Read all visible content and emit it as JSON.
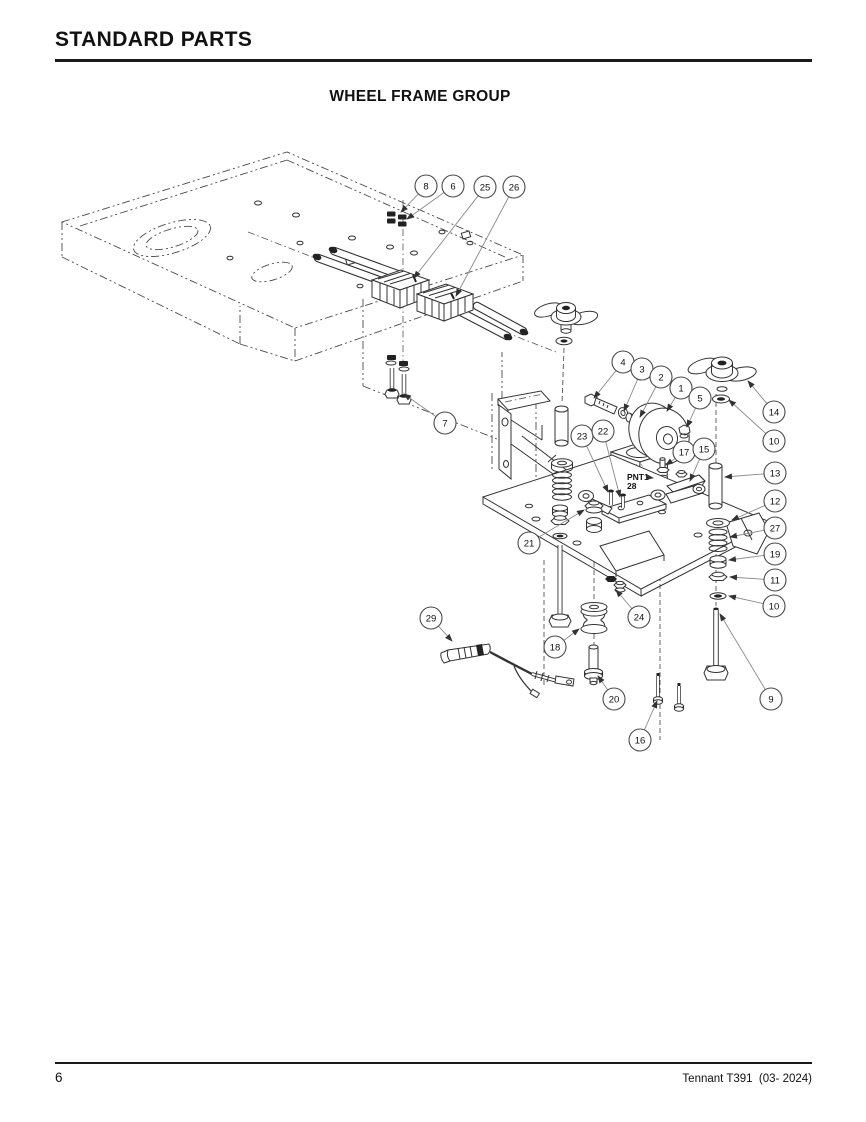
{
  "page": {
    "header_title": "STANDARD PARTS",
    "diagram_title": "WHEEL FRAME GROUP",
    "footer_page_number": "6",
    "footer_right": "Tennant T391  (03- 2024)"
  },
  "diagram": {
    "paint_note": {
      "code": "PNT1",
      "item": "28"
    },
    "callouts": [
      {
        "n": "8",
        "x": 426,
        "y": 186,
        "tx": 401,
        "ty": 212
      },
      {
        "n": "6",
        "x": 453,
        "y": 186,
        "tx": 407,
        "ty": 219
      },
      {
        "n": "25",
        "x": 485,
        "y": 187,
        "tx": 414,
        "ty": 278
      },
      {
        "n": "26",
        "x": 514,
        "y": 187,
        "tx": 456,
        "ty": 296
      },
      {
        "n": "7",
        "x": 445,
        "y": 423,
        "tx": 404,
        "ty": 394
      },
      {
        "n": "4",
        "x": 623,
        "y": 362,
        "tx": 594,
        "ty": 398
      },
      {
        "n": "3",
        "x": 642,
        "y": 369,
        "tx": 624,
        "ty": 411
      },
      {
        "n": "2",
        "x": 661,
        "y": 377,
        "tx": 640,
        "ty": 417
      },
      {
        "n": "1",
        "x": 681,
        "y": 388,
        "tx": 667,
        "ty": 411
      },
      {
        "n": "5",
        "x": 700,
        "y": 398,
        "tx": 687,
        "ty": 427
      },
      {
        "n": "14",
        "x": 774,
        "y": 412,
        "tx": 748,
        "ty": 381
      },
      {
        "n": "10",
        "x": 774,
        "y": 441,
        "tx": 729,
        "ty": 400
      },
      {
        "n": "23",
        "x": 582,
        "y": 436,
        "tx": 608,
        "ty": 492
      },
      {
        "n": "22",
        "x": 603,
        "y": 431,
        "tx": 620,
        "ty": 497
      },
      {
        "n": "17",
        "x": 684,
        "y": 452,
        "tx": 666,
        "ty": 465
      },
      {
        "n": "15",
        "x": 704,
        "y": 449,
        "tx": 690,
        "ty": 481
      },
      {
        "n": "13",
        "x": 775,
        "y": 473,
        "tx": 725,
        "ty": 477
      },
      {
        "n": "12",
        "x": 775,
        "y": 501,
        "tx": 732,
        "ty": 520
      },
      {
        "n": "27",
        "x": 775,
        "y": 528,
        "tx": 730,
        "ty": 537
      },
      {
        "n": "19",
        "x": 775,
        "y": 554,
        "tx": 729,
        "ty": 560
      },
      {
        "n": "11",
        "x": 775,
        "y": 580,
        "tx": 730,
        "ty": 577
      },
      {
        "n": "10",
        "x": 774,
        "y": 606,
        "tx": 729,
        "ty": 596
      },
      {
        "n": "21",
        "x": 529,
        "y": 543,
        "tx": 584,
        "ty": 510
      },
      {
        "n": "24",
        "x": 639,
        "y": 617,
        "tx": 616,
        "ty": 590
      },
      {
        "n": "29",
        "x": 431,
        "y": 618,
        "tx": 452,
        "ty": 641
      },
      {
        "n": "18",
        "x": 555,
        "y": 647,
        "tx": 579,
        "ty": 629
      },
      {
        "n": "20",
        "x": 614,
        "y": 699,
        "tx": 598,
        "ty": 676
      },
      {
        "n": "16",
        "x": 640,
        "y": 740,
        "tx": 657,
        "ty": 701
      },
      {
        "n": "9",
        "x": 771,
        "y": 699,
        "tx": 720,
        "ty": 614
      }
    ]
  },
  "colors": {
    "line": "#333333",
    "leader": "#8a8a8a",
    "text": "#111111",
    "paper": "#ffffff"
  }
}
